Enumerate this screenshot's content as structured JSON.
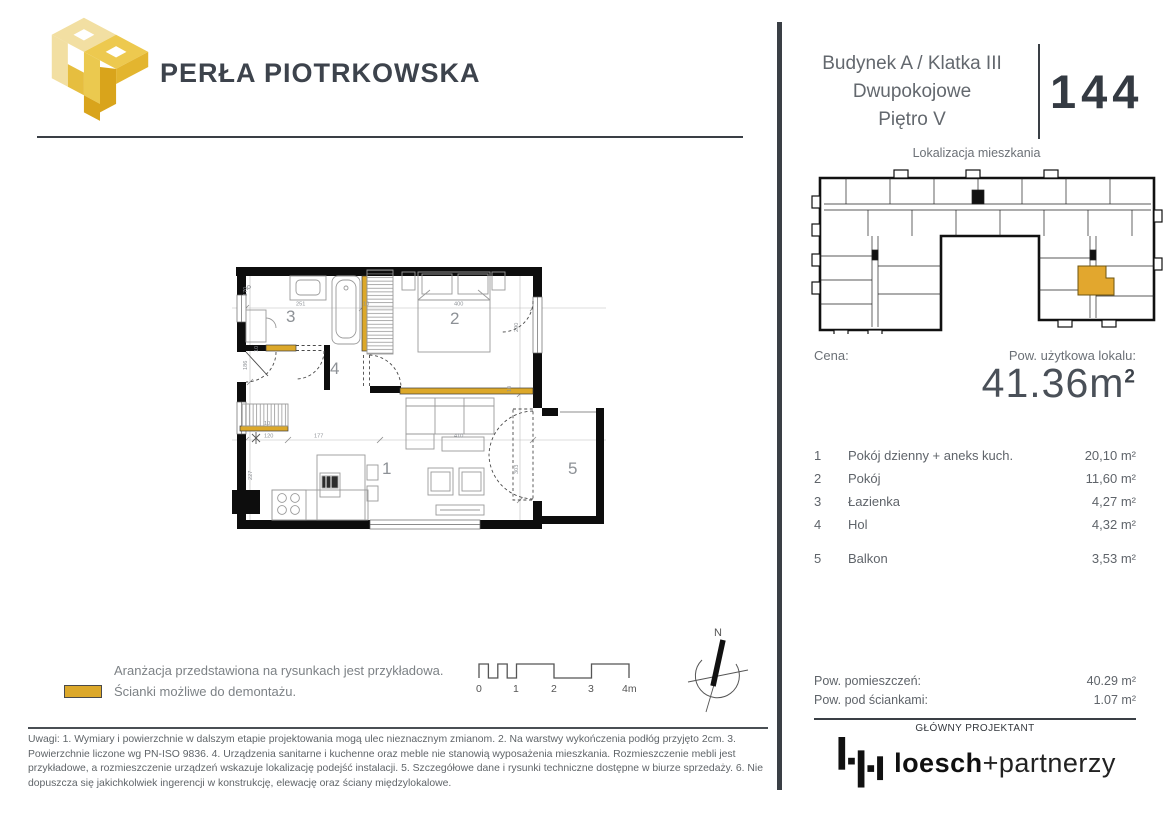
{
  "brand": {
    "name": "PERŁA PIOTRKOWSKA"
  },
  "unit": {
    "building": "Budynek A / Klatka III",
    "type": "Dwupokojowe",
    "floor": "Piętro V",
    "number": "144"
  },
  "locator": {
    "title": "Lokalizacja mieszkania"
  },
  "pricing": {
    "price_label": "Cena:",
    "area_label": "Pow. użytkowa lokalu:",
    "area_value": "41.36m",
    "area_sup": "2"
  },
  "rooms": {
    "items": [
      {
        "no": "1",
        "name": "Pokój dzienny + aneks kuch.",
        "area": "20,10 m²"
      },
      {
        "no": "2",
        "name": "Pokój",
        "area": "11,60 m²"
      },
      {
        "no": "3",
        "name": "Łazienka",
        "area": "4,27 m²"
      },
      {
        "no": "4",
        "name": "Hol",
        "area": "4,32 m²"
      },
      {
        "no": "5",
        "name": "Balkon",
        "area": "3,53 m²"
      }
    ]
  },
  "totals": {
    "rooms_label": "Pow. pomieszczeń:",
    "rooms_value": "40.29 m²",
    "walls_label": "Pow. pod ściankami:",
    "walls_value": "1.07 m²"
  },
  "designer": {
    "heading": "GŁÓWNY PROJEKTANT",
    "name_bold": "loesch",
    "name_light": "+partnerzy"
  },
  "legend": {
    "arrangement_note": "Aranżacja przedstawiona na rysunkach jest przykładowa.",
    "demolition_note": "Ścianki możliwe do demontażu.",
    "swatch_color": "#DCA82A"
  },
  "scalebar": {
    "labels": [
      "0",
      "1",
      "2",
      "3",
      "4m"
    ]
  },
  "compass": {
    "north": "N"
  },
  "floorplan": {
    "room_labels": [
      "1",
      "2",
      "3",
      "4",
      "5"
    ],
    "p_label": "P",
    "dims": [
      "170",
      "251",
      "10",
      "400",
      "290",
      "186",
      "10",
      "120",
      "177",
      "410",
      "227",
      "303",
      "10",
      "10"
    ]
  },
  "colors": {
    "accent_gold": "#DCA82A",
    "wall_black": "#0d0d0d",
    "divider": "#3a3f45"
  },
  "footnote": "Uwagi: 1. Wymiary i powierzchnie w dalszym etapie projektowania mogą ulec nieznacznym zmianom.  2. Na warstwy wykończenia podłóg przyjęto 2cm. 3. Powierzchnie liczone wg PN-ISO 9836.  4. Urządzenia sanitarne i kuchenne oraz meble nie stanowią wyposażenia mieszkania. Rozmieszczenie mebli jest przykładowe, a rozmieszczenie urządzeń wskazuje lokalizację podejść instalacji.  5. Szczegółowe dane i rysunki techniczne dostępne w biurze sprzedaży.  6. Nie dopuszcza się jakichkolwiek ingerencji w konstrukcję, elewację oraz ściany międzylokalowe."
}
